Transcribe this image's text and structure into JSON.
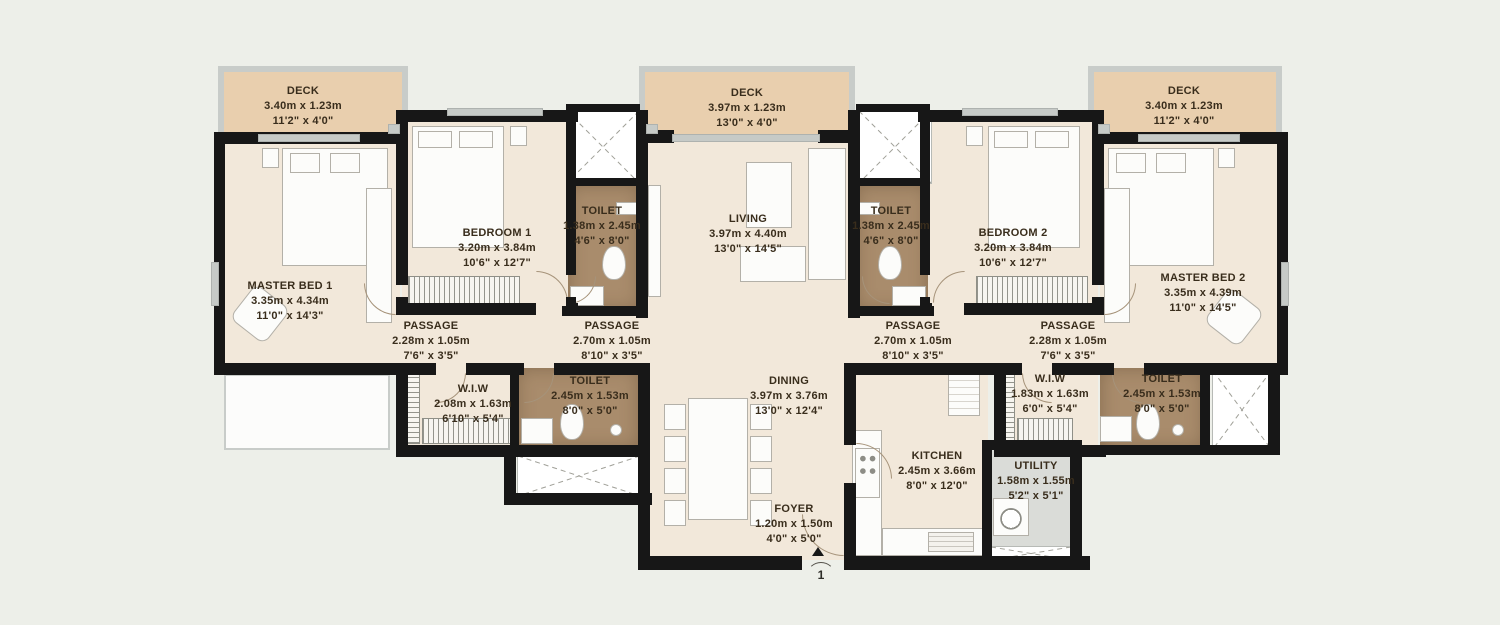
{
  "colors": {
    "wall": "#171717",
    "floor": "#f2e8da",
    "deck": "#e9cfae",
    "toilet_tile": "#a98c6c",
    "utility": "#dadcd8",
    "background": "#edefe9",
    "label_text": "#392d1c"
  },
  "rooms": [
    {
      "id": "deck-left",
      "name": "DECK",
      "dim_m": "3.40m x 1.23m",
      "dim_ft": "11'2\" x 4'0\""
    },
    {
      "id": "deck-center",
      "name": "DECK",
      "dim_m": "3.97m x 1.23m",
      "dim_ft": "13'0\" x 4'0\""
    },
    {
      "id": "deck-right",
      "name": "DECK",
      "dim_m": "3.40m x 1.23m",
      "dim_ft": "11'2\" x 4'0\""
    },
    {
      "id": "master-bed-1",
      "name": "MASTER BED 1",
      "dim_m": "3.35m x 4.34m",
      "dim_ft": "11'0\" x 14'3\""
    },
    {
      "id": "bedroom-1",
      "name": "BEDROOM 1",
      "dim_m": "3.20m x 3.84m",
      "dim_ft": "10'6\" x 12'7\""
    },
    {
      "id": "toilet-1",
      "name": "TOILET",
      "dim_m": "1.38m x 2.45m",
      "dim_ft": "4'6\" x 8'0\""
    },
    {
      "id": "living",
      "name": "LIVING",
      "dim_m": "3.97m x 4.40m",
      "dim_ft": "13'0\" x 14'5\""
    },
    {
      "id": "toilet-2",
      "name": "TOILET",
      "dim_m": "1.38m x 2.45m",
      "dim_ft": "4'6\" x 8'0\""
    },
    {
      "id": "bedroom-2",
      "name": "BEDROOM 2",
      "dim_m": "3.20m x 3.84m",
      "dim_ft": "10'6\" x 12'7\""
    },
    {
      "id": "master-bed-2",
      "name": "MASTER BED 2",
      "dim_m": "3.35m x 4.39m",
      "dim_ft": "11'0\" x 14'5\""
    },
    {
      "id": "passage-1",
      "name": "PASSAGE",
      "dim_m": "2.28m x 1.05m",
      "dim_ft": "7'6\" x 3'5\""
    },
    {
      "id": "passage-2",
      "name": "PASSAGE",
      "dim_m": "2.70m x 1.05m",
      "dim_ft": "8'10\" x 3'5\""
    },
    {
      "id": "passage-3",
      "name": "PASSAGE",
      "dim_m": "2.70m x 1.05m",
      "dim_ft": "8'10\" x 3'5\""
    },
    {
      "id": "passage-4",
      "name": "PASSAGE",
      "dim_m": "2.28m x 1.05m",
      "dim_ft": "7'6\" x 3'5\""
    },
    {
      "id": "wiw-1",
      "name": "W.I.W",
      "dim_m": "2.08m x 1.63m",
      "dim_ft": "6'10\" x 5'4\""
    },
    {
      "id": "toilet-3",
      "name": "TOILET",
      "dim_m": "2.45m x 1.53m",
      "dim_ft": "8'0\" x 5'0\""
    },
    {
      "id": "dining",
      "name": "DINING",
      "dim_m": "3.97m x 3.76m",
      "dim_ft": "13'0\" x 12'4\""
    },
    {
      "id": "wiw-2",
      "name": "W.I.W",
      "dim_m": "1.83m x 1.63m",
      "dim_ft": "6'0\" x 5'4\""
    },
    {
      "id": "toilet-4",
      "name": "TOILET",
      "dim_m": "2.45m x 1.53m",
      "dim_ft": "8'0\" x 5'0\""
    },
    {
      "id": "kitchen",
      "name": "KITCHEN",
      "dim_m": "2.45m x 3.66m",
      "dim_ft": "8'0\" x 12'0\""
    },
    {
      "id": "utility",
      "name": "UTILITY",
      "dim_m": "1.58m x 1.55m",
      "dim_ft": "5'2\" x 5'1\""
    },
    {
      "id": "foyer",
      "name": "FOYER",
      "dim_m": "1.20m x 1.50m",
      "dim_ft": "4'0\" x 5'0\""
    }
  ],
  "entry": {
    "marker": "1"
  }
}
